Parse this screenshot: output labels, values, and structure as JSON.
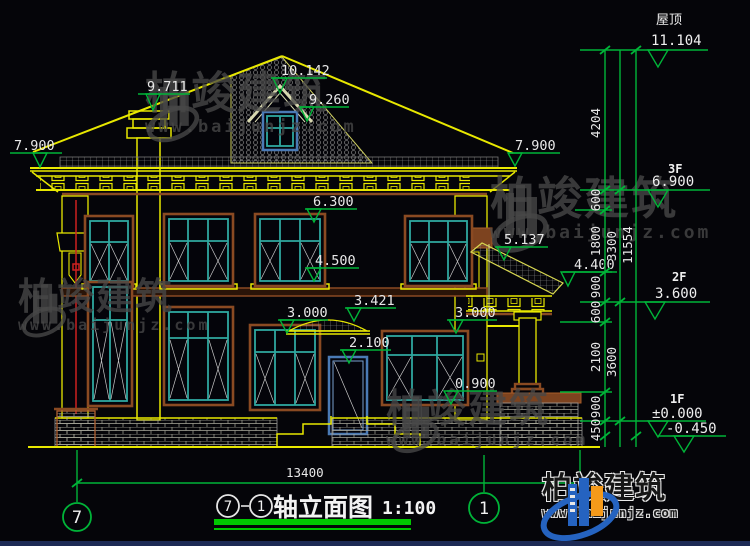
{
  "drawing": {
    "title": {
      "axis_a": "7",
      "axis_b": "1",
      "dash": "-",
      "name": "轴立面图",
      "scale": "1:100"
    },
    "axis_bubbles": {
      "left": "7",
      "right": "1"
    },
    "elevations": {
      "chimney": "9.711",
      "ridge": "10.142",
      "dormer": "9.260",
      "eave_left": "7.900",
      "eave_right": "7.900",
      "cornice": "6.300",
      "sill_2f": "4.500",
      "porch_top": "5.137",
      "porch_eave": "4.400",
      "awning": "3.421",
      "win_top_left": "3.000",
      "win_top_right": "3.000",
      "door_top": "2.100",
      "sill_1f": "0.900"
    },
    "levels": {
      "roof_label": "屋顶",
      "roof": "11.104",
      "f3_label": "3F",
      "f3": "6.900",
      "f2_label": "2F",
      "f2": "3.600",
      "f1_label": "1F",
      "f1": "±0.000",
      "ground": "-0.450"
    },
    "dims": {
      "seg_roof": "4204",
      "seg_600a": "600",
      "seg_1800": "1800",
      "seg_900a": "900",
      "seg_600b": "600",
      "seg_2100": "2100",
      "seg_900b": "900",
      "seg_450": "450",
      "floor_3to2": "3300",
      "floor_2to1": "3600",
      "overall_height": "11554",
      "overall_width": "13400"
    }
  },
  "watermark": {
    "brand": "柏竣建筑",
    "url": "www.baijunjz.com"
  },
  "logo": {
    "brand": "柏竣建筑",
    "url": "www.baijunjz.com"
  },
  "colors": {
    "dim_green": "#00b438",
    "line_yellow": "#e8e800",
    "frame_teal": "#2fa8a0",
    "frame_brown": "#8a4a22",
    "door_blue": "#4a7ab5",
    "downspout_red": "#cc2020",
    "logo_blue": "#2563c0",
    "logo_orange": "#f59a1a"
  }
}
